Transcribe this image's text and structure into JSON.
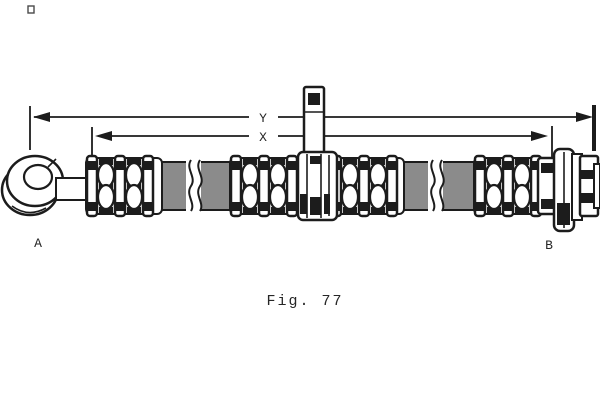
{
  "figure": {
    "caption": "Fig. 77",
    "dimension_labels": {
      "outer": "Y",
      "inner": "X"
    },
    "end_labels": {
      "left": "A",
      "right": "B"
    },
    "colors": {
      "line": "#1c1c1c",
      "hose_gray": "#8b8b8b",
      "background": "#ffffff"
    }
  }
}
